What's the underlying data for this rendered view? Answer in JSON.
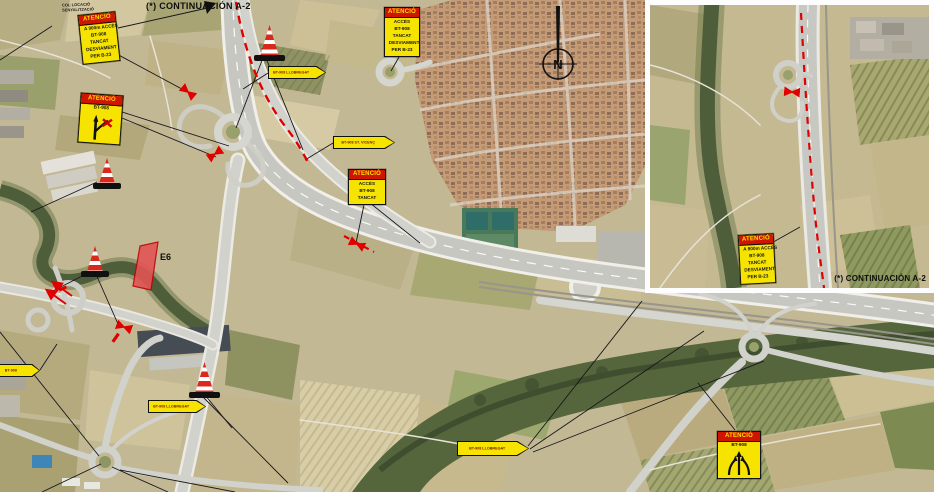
{
  "map": {
    "continuation_label": "(*) CONTINUACIÓN A-2",
    "corner_note_l1": "COL·LOCACIÓ",
    "corner_note_l2": "SENYALITZACIÓ",
    "work_zone_label": "E6",
    "compass": "N"
  },
  "inset": {
    "continuation_label": "(*) CONTINUACIÓN A-2"
  },
  "signs": {
    "attention": "ATENCIÓ",
    "attn_topleft": {
      "lines": [
        "A 900m ACCÉS",
        "BT-908",
        "TANCAT",
        "DESVIAMENT",
        "PER B-23"
      ]
    },
    "attn_branch": {
      "road": "BT-908"
    },
    "attn_topcenter": {
      "lines": [
        "ACCÉS",
        "BT-908",
        "TANCAT",
        "DESVIAMENT",
        "PER B-23"
      ]
    },
    "attn_center": {
      "lines": [
        "ACCÉS",
        "BT-908",
        "TANCAT"
      ]
    },
    "attn_merge": {
      "road": "BT-908"
    },
    "attn_inset": {
      "lines": [
        "A 900m ACCÉS",
        "BT-908",
        "TANCAT",
        "DESVIAMENT",
        "PER B-23"
      ]
    },
    "arrow_1": "BT-908 LLOBREGAT",
    "arrow_2": "BT-908 ST. VICENÇ",
    "arrow_3": "BT-908 LLOBREGAT",
    "arrow_4": "BT-908 LLOBREGAT",
    "arrow_5": "BT-908"
  },
  "colors": {
    "sign_yellow": "#f6e400",
    "sign_header_red": "#cf1400",
    "route_red": "#e10000",
    "map_base": "#c3b894"
  }
}
